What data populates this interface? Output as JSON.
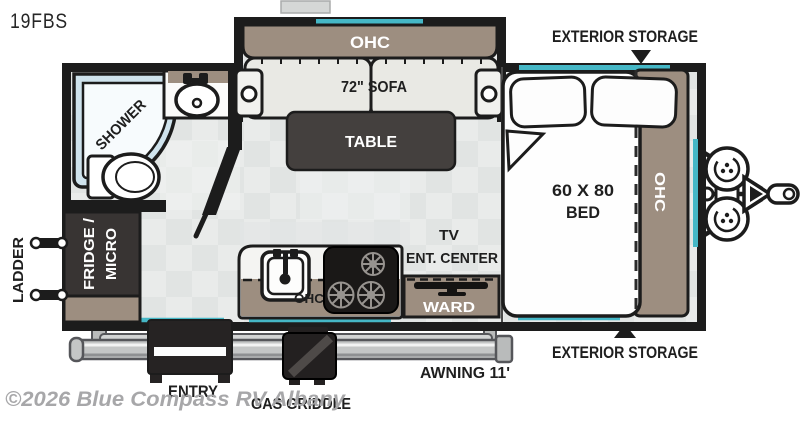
{
  "title": "19FBS",
  "watermark": "©2026 Blue Compass RV Albany",
  "colors": {
    "accent_teal": "#45b7c6",
    "wall": "#1c1c1c",
    "cabinet_taupe": "#9d8e80",
    "floor": "#e9ebea"
  },
  "labels": {
    "exterior_storage_top": "EXTERIOR STORAGE",
    "exterior_storage_bottom": "EXTERIOR STORAGE",
    "sofa_ohc": "OHC",
    "sofa": "72\" SOFA",
    "table": "TABLE",
    "shower": "SHOWER",
    "fridge_line1": "FRIDGE /",
    "fridge_line2": "MICRO",
    "ladder": "LADDER",
    "kitchen_ohc": "OHC",
    "tv_line1": "TV",
    "tv_line2": "ENT. CENTER",
    "ward": "WARD",
    "bed_size": "60 X 80",
    "bed": "BED",
    "bed_ohc": "OHC",
    "entry": "ENTRY",
    "gas_griddle": "GAS GRIDDLE",
    "awning": "AWNING 11'"
  }
}
